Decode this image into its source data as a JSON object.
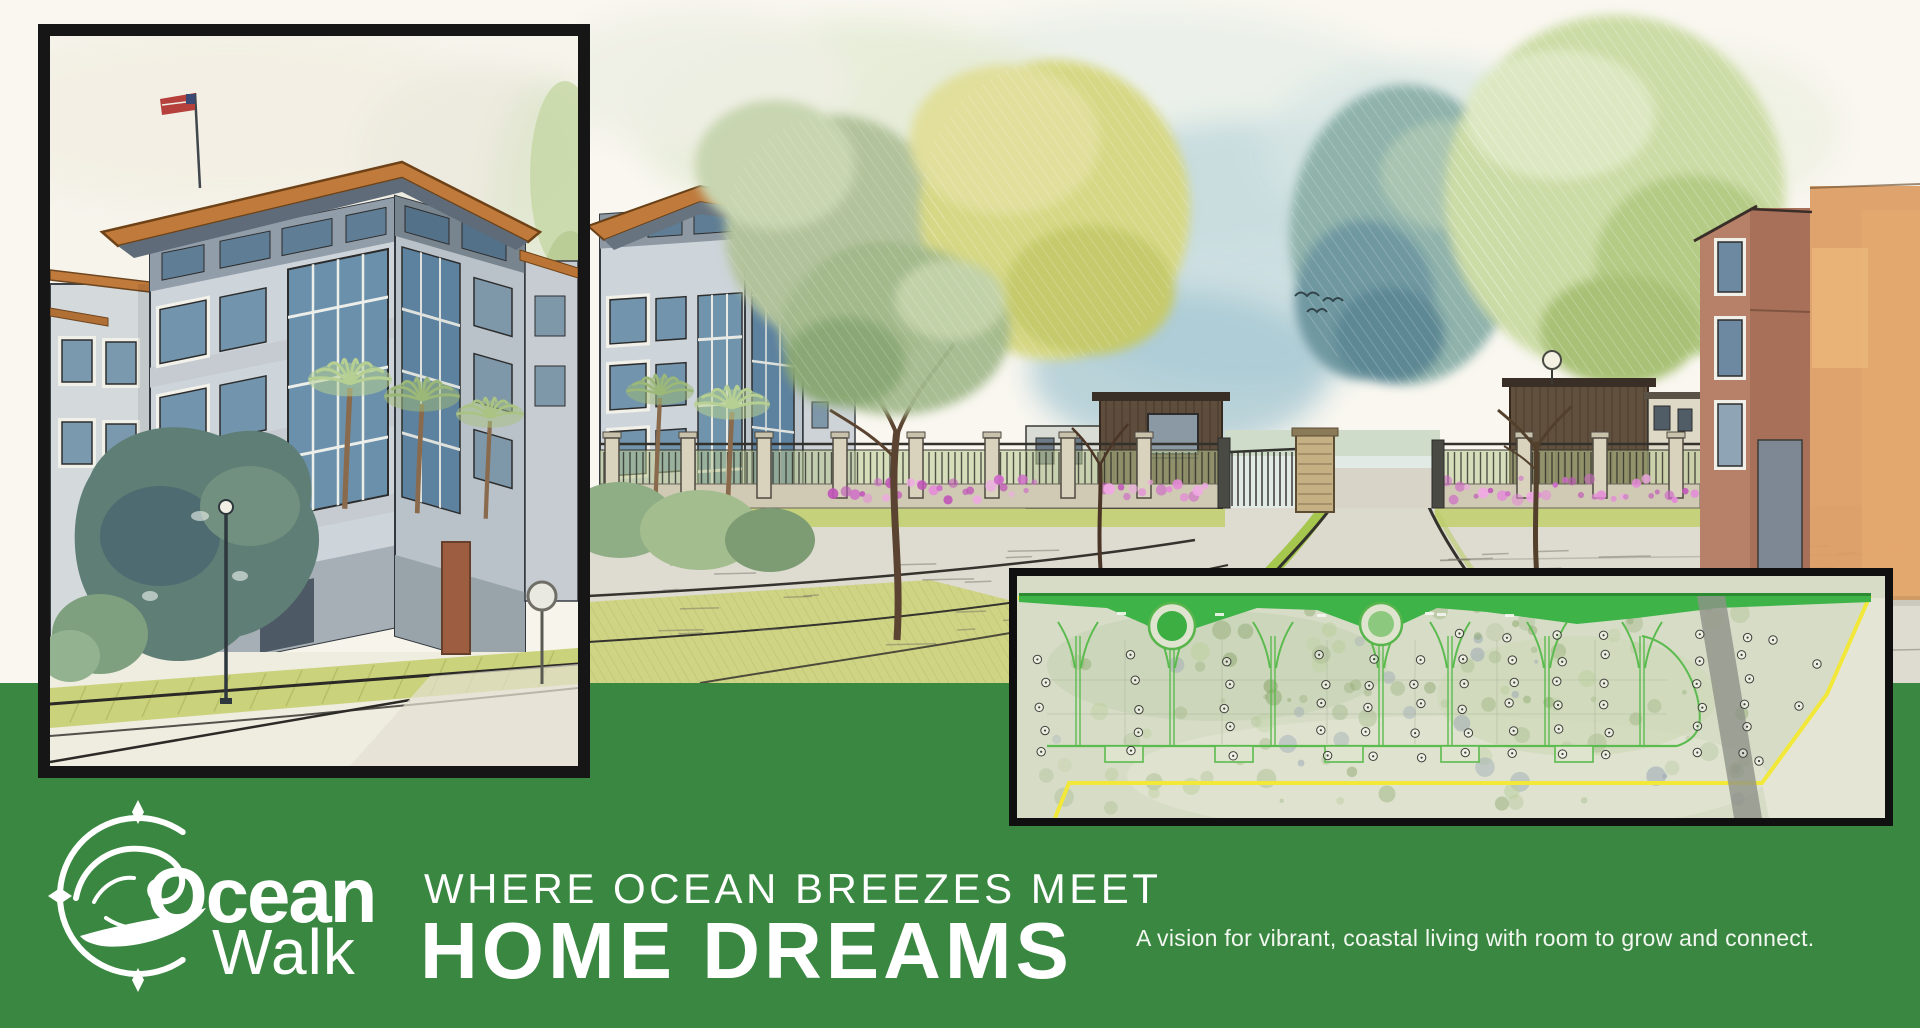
{
  "meta": {
    "kind": "real-estate promotional banner",
    "art_style": "watercolor architectural rendering"
  },
  "brand": {
    "line1": "Ocean",
    "line2": "Walk",
    "logo_icon": "compass-wave-icon"
  },
  "hero": {
    "kicker": "WHERE OCEAN BREEZES MEET",
    "title": "HOME DREAMS",
    "tagline": "A vision for vibrant, coastal living with room to grow and connect."
  },
  "panels": {
    "building_inset": {
      "description": "framed watercolor close-up of a four-story coastal condo building with copper roof trim and flag"
    },
    "main_scene": {
      "description": "watercolor street view of a gated community entrance with fence, flowers, gatehouses and stone pier",
      "birds": 3
    },
    "site_plan": {
      "description": "aerial master-plan inset with yellow property boundary, green streets, two roundabouts and numbered lots",
      "roundabouts": 2
    }
  },
  "palette": {
    "band": "#3a8742",
    "paper": "#f9f7f0",
    "ink": "#33312c",
    "picket": "#2e2e2a",
    "fencePost": "#d9d3bd",
    "fenceBase": "#d0cab4",
    "hedge": "#b9c98f",
    "lawn": "#c6d17c",
    "vergeBright": "#9fc43f",
    "road": "#dedbd0",
    "copper": "#bf7a3c",
    "wallLight": "#ced5da",
    "wallShade": "#bcc5cc",
    "glass": "#6f94ac",
    "glassDark": "#5d82a0",
    "gateWood": "#5e4c3d",
    "pierBrick": "#c5b084",
    "brickTower": "#a87058",
    "orangeWall": "#dc9c63",
    "treeSage": "#b2c39b",
    "treeYellow": "#d7d885",
    "treeTeal": "#8fb2ab",
    "treeLight": "#ccdca6",
    "trunk": "#5a4330",
    "flowerPinks": [
      "#e58ad8",
      "#cf6cc8",
      "#f0a8e4",
      "#c055b8"
    ],
    "planBg": "#d6dcc6",
    "planGreenBright": "#3db348",
    "planRoad": "#5cbb4f",
    "boundaryYellow": "#f2e83a",
    "planGray": "#8f9288",
    "markerInk": "#3f3f3a"
  }
}
